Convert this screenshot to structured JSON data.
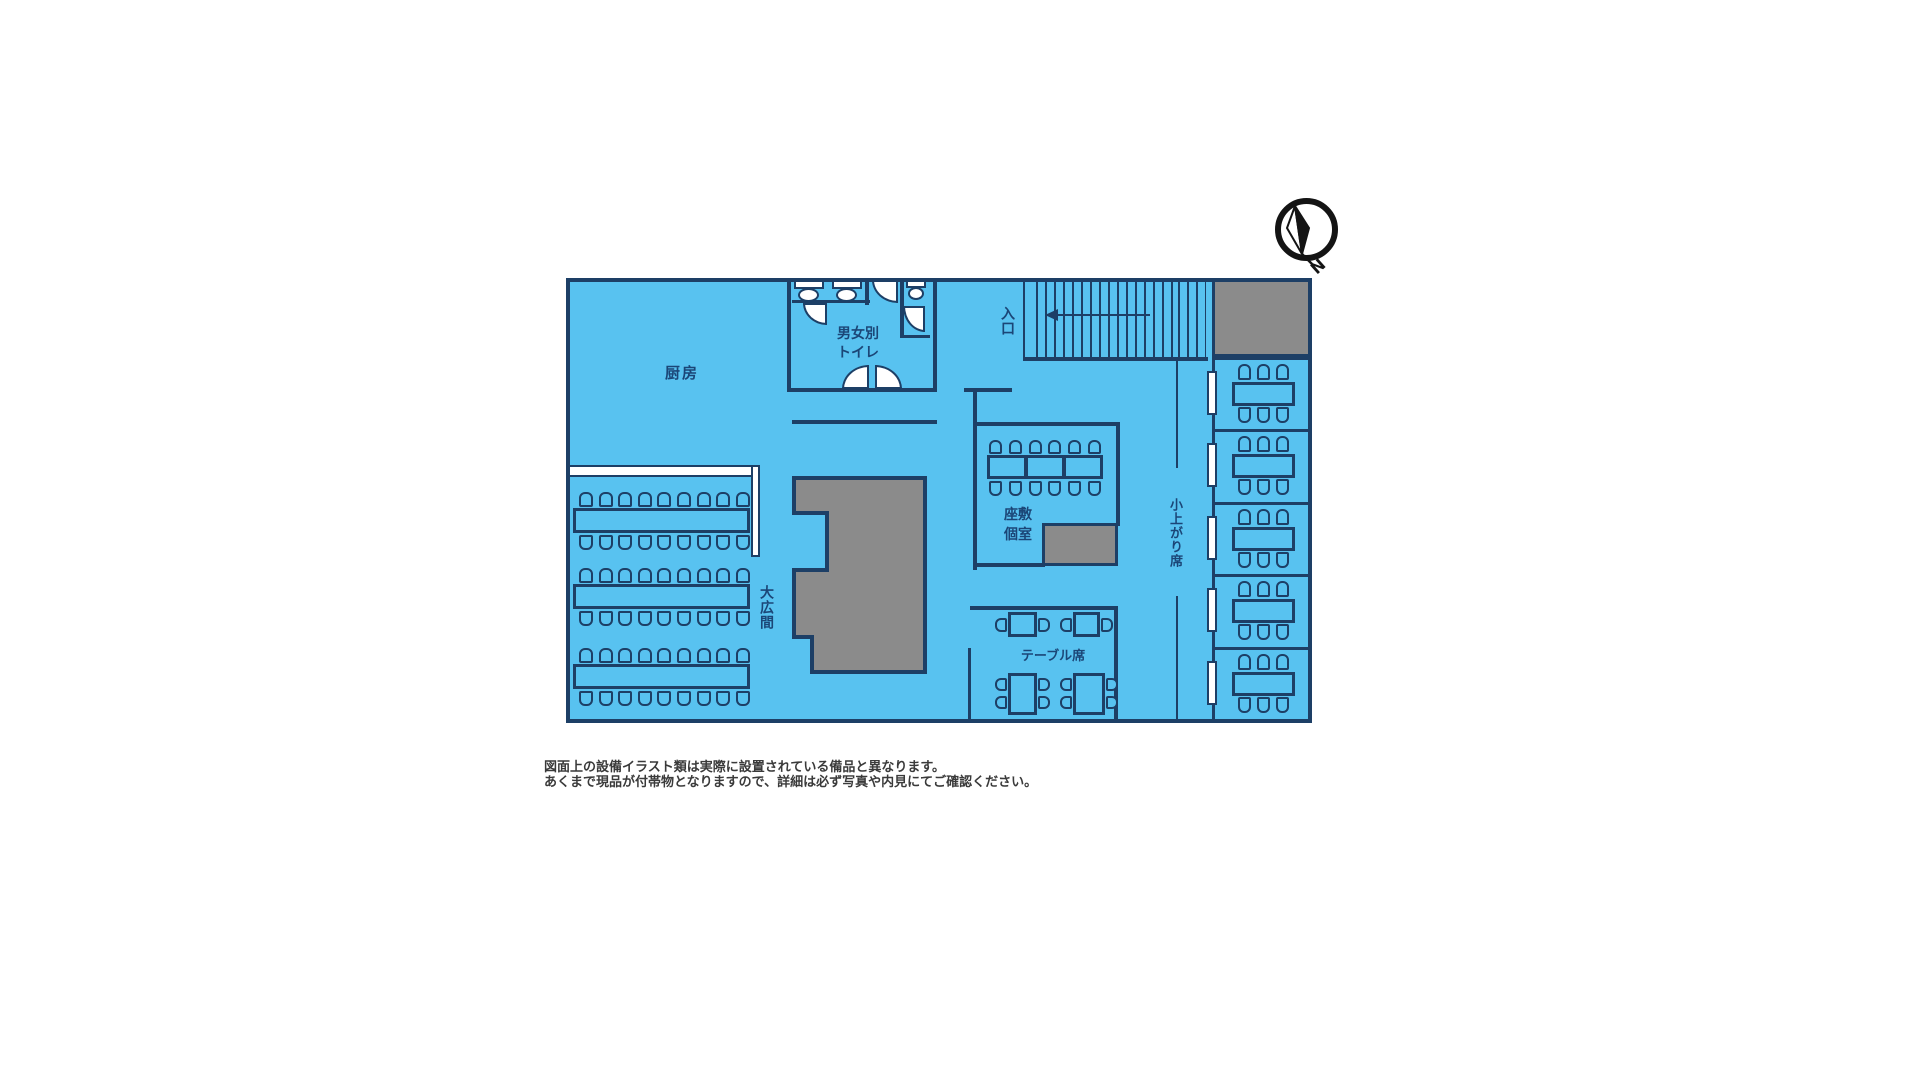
{
  "colors": {
    "floor": "#58c2f0",
    "wall": "#1d3f66",
    "label": "#1b4677",
    "gray": "#8b8b8b",
    "caption": "#3a3a3a",
    "compassc": "#141414",
    "background": "#ffffff"
  },
  "compass": {
    "label": "N"
  },
  "rooms": {
    "kitchen": {
      "label": "厨房"
    },
    "toilet": {
      "line1": "男女別",
      "line2": "トイレ"
    },
    "entrance": {
      "label": "入口"
    },
    "zashiki": {
      "line1": "座敷",
      "line2": "個室"
    },
    "ohiroma": {
      "label": "大広間"
    },
    "table_seats": {
      "label": "テーブル席"
    },
    "koagari": {
      "label": "小上がり席"
    }
  },
  "furniture": {
    "ohiroma": {
      "tables": 3,
      "seats_per_side": 9
    },
    "zashiki": {
      "tables": 3,
      "seats_per_side": 6
    },
    "koagari_booths": {
      "count": 5,
      "seats_per_side": 3
    },
    "table_seats": {
      "two_person_tables": 2,
      "four_person_tables": 2
    },
    "toilets": 3
  },
  "caption": {
    "line1": "図面上の設備イラスト類は実際に設置されている備品と異なります。",
    "line2": "あくまで現品が付帯物となりますので、詳細は必ず写真や内見にてご確認ください。"
  }
}
